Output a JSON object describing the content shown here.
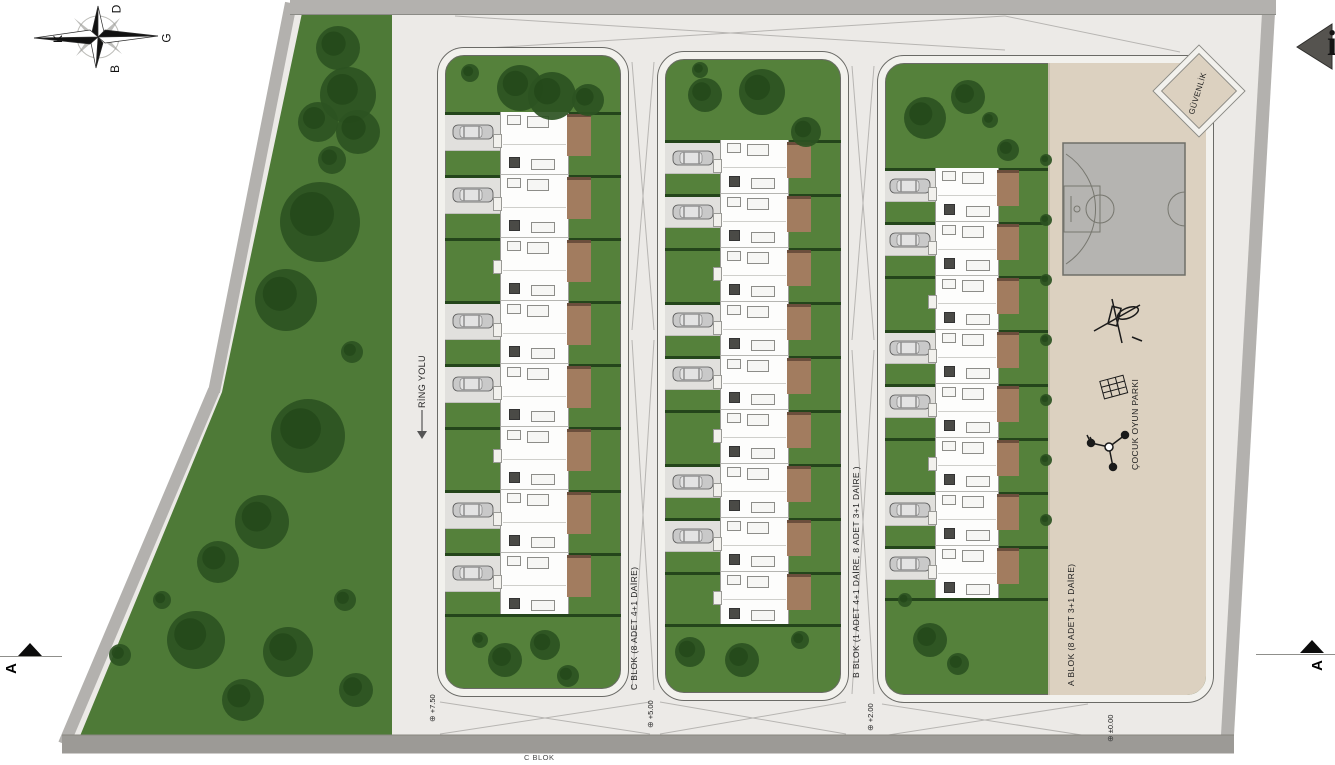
{
  "compass": {
    "top": "D",
    "left": "K",
    "right": "G",
    "bottom": "B"
  },
  "road_label": {
    "text": "RİNG YOLU"
  },
  "blocks": [
    {
      "name": "C",
      "label": "C BLOK (8 ADET 4+1 DAİRE)",
      "units": 8
    },
    {
      "name": "B",
      "label": "B BLOK (1 ADET 4+1 DAİRE, 8 ADET 3+1 DAİRE )",
      "units": 9
    },
    {
      "name": "A",
      "label": "A BLOK (8 ADET 3+1 DAİRE)",
      "units": 8
    }
  ],
  "amenities": {
    "security": "GÜVENLİK",
    "playground": "ÇOCUK OYUN PARKI"
  },
  "elevation_markers": [
    {
      "value": "+7.50"
    },
    {
      "value": "+5.00"
    },
    {
      "value": "+2.00"
    },
    {
      "value": "±0.00"
    }
  ],
  "section_markers": {
    "left": "A",
    "right": "A"
  },
  "footer": {
    "block_label": "C BLOK"
  },
  "edge_marker": {
    "fragment": "i"
  },
  "colors": {
    "paved": "#ECEAE7",
    "park": "#4E7A37",
    "lawn": "#55813B",
    "tree": "#2C5322",
    "beige": "#DCD1C0",
    "walk": "#F2F1ED",
    "strip": "#B3B1AE",
    "stripD": "#9C9A96",
    "hedge": "#24451B",
    "terrace": "#A27C5F",
    "drive": "#E1E0DD",
    "court": "#B5B4B1",
    "line": "#8B8B84",
    "text": "#1F1F1F"
  }
}
